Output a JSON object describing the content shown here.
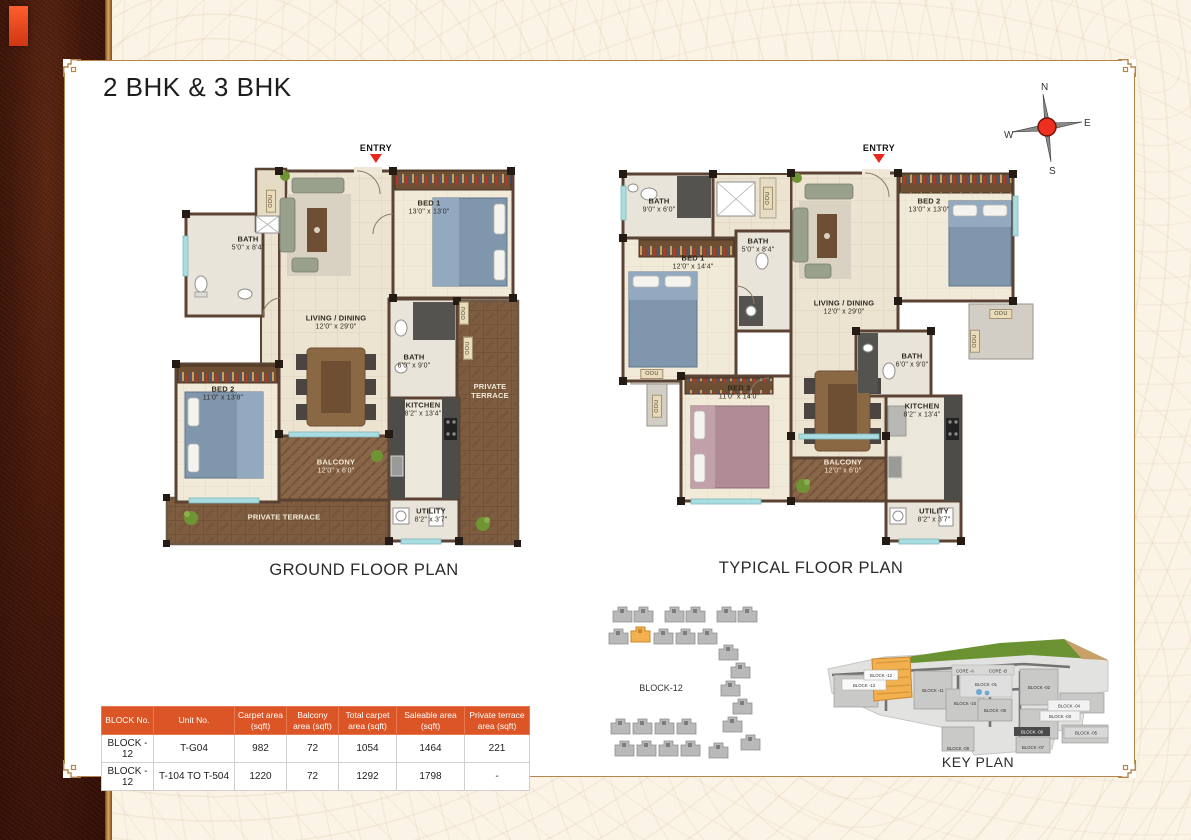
{
  "page": {
    "title": "2 BHK & 3 BHK"
  },
  "compass": {
    "north": "N",
    "east": "E",
    "south": "S",
    "west": "W"
  },
  "entry_label": "ENTRY",
  "odu_label": "ODU",
  "ground_plan": {
    "caption": "GROUND FLOOR PLAN",
    "rooms": [
      {
        "name": "BATH",
        "dims": "5'0\" x 8'4\""
      },
      {
        "name": "BED 1",
        "dims": "13'0\" x 13'0\""
      },
      {
        "name": "LIVING / DINING",
        "dims": "12'0\" x 29'0\""
      },
      {
        "name": "BED 2",
        "dims": "11'0\" x 13'8\""
      },
      {
        "name": "BATH",
        "dims": "6'0\" x 9'0\""
      },
      {
        "name": "KITCHEN",
        "dims": "8'2\" x 13'4\""
      },
      {
        "name": "PRIVATE TERRACE",
        "dims": ""
      },
      {
        "name": "BALCONY",
        "dims": "12'0\" x 6'0\""
      },
      {
        "name": "PRIVATE TERRACE",
        "dims": ""
      },
      {
        "name": "UTILITY",
        "dims": "8'2\" x 3'7\""
      }
    ]
  },
  "typical_plan": {
    "caption": "TYPICAL FLOOR PLAN",
    "rooms": [
      {
        "name": "BATH",
        "dims": "9'0\" x 6'0\""
      },
      {
        "name": "BED 1",
        "dims": "12'0\" x 14'4\""
      },
      {
        "name": "BATH",
        "dims": "5'0\" x 8'4\""
      },
      {
        "name": "BED 2",
        "dims": "13'0\" x 13'0\""
      },
      {
        "name": "LIVING / DINING",
        "dims": "12'0\" x 29'0\""
      },
      {
        "name": "BATH",
        "dims": "6'0\" x 9'0\""
      },
      {
        "name": "BED 3",
        "dims": "11'0\" x 14'0\""
      },
      {
        "name": "KITCHEN",
        "dims": "8'2\" x 13'4\""
      },
      {
        "name": "BALCONY",
        "dims": "12'0\" x 6'0\""
      },
      {
        "name": "UTILITY",
        "dims": "8'2\" x 3'7\""
      }
    ]
  },
  "area_table": {
    "headers": [
      "BLOCK No.",
      "Unit No.",
      "Carpet area (sqft)",
      "Balcony area (sqft)",
      "Total carpet area (sqft)",
      "Saleable area (sqft)",
      "Private terrace area (sqft)"
    ],
    "rows": [
      [
        "BLOCK - 12",
        "T-G04",
        "982",
        "72",
        "1054",
        "1464",
        "221"
      ],
      [
        "BLOCK - 12",
        "T-104 TO T-504",
        "1220",
        "72",
        "1292",
        "1798",
        "-"
      ]
    ]
  },
  "block_diagram": {
    "label": "BLOCK-12"
  },
  "key_plan": {
    "caption": "KEY PLAN",
    "blocks": [
      "BLOCK -13",
      "BLOCK -12",
      "BLOCK -11",
      "CORE -A",
      "CORE -B",
      "BLOCK -01",
      "BLOCK -02",
      "BLOCK -10",
      "BLOCK -08",
      "BLOCK -03",
      "BLOCK -04",
      "BLOCK -06",
      "BLOCK -05",
      "BLOCK -09",
      "BLOCK -07"
    ]
  },
  "colors": {
    "accent_orange": "#dc5526",
    "maroon": "#3a150c",
    "gold": "#b5854d",
    "highlight": "#f2b04e"
  }
}
